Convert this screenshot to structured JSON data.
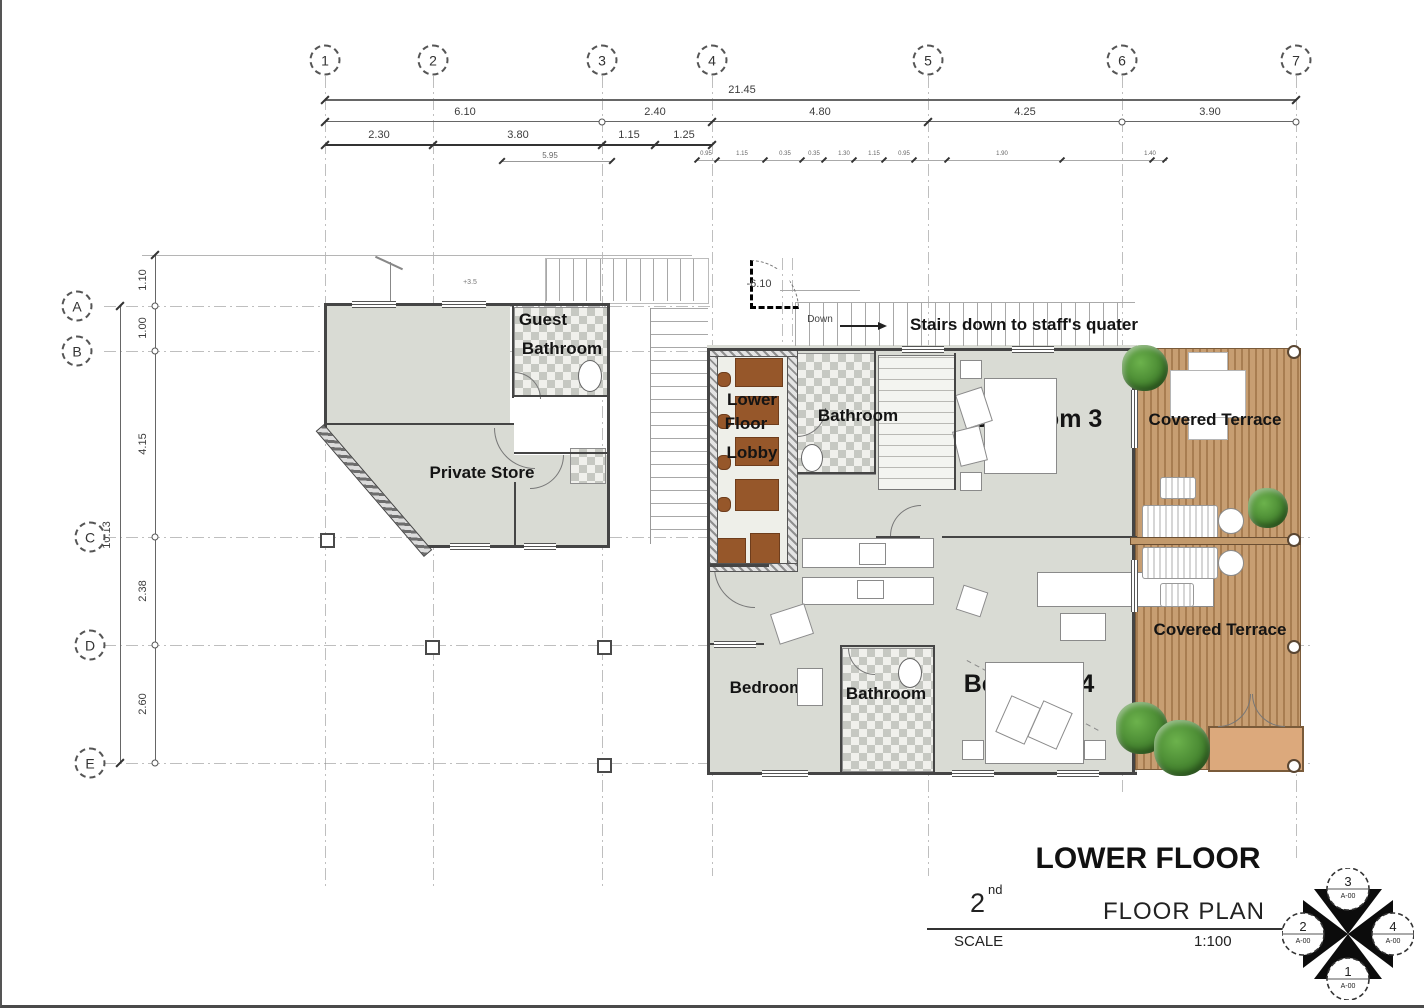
{
  "grid": {
    "columns": [
      "1",
      "2",
      "3",
      "4",
      "5",
      "6",
      "7"
    ],
    "rows": [
      "A",
      "B",
      "C",
      "D",
      "E"
    ]
  },
  "dims": {
    "total": "21.45",
    "seg2": [
      "6.10",
      "2.40",
      "4.80",
      "4.25",
      "3.90"
    ],
    "seg3": [
      "2.30",
      "3.80",
      "1.15",
      "1.25"
    ],
    "sub": "5.95",
    "tiny": [
      "0.95",
      "1.15",
      "0.35",
      "0.35",
      "1.30",
      "1.15",
      "0.95",
      "1.90",
      "1.40"
    ],
    "left": [
      "1.10",
      "1.00",
      "4.15",
      "2.38",
      "2.60"
    ],
    "left_total": "10.13"
  },
  "levels": {
    "lobby": "-6.10",
    "entry": "+3.5",
    "down": "Down"
  },
  "note": {
    "stairs": "Stairs down to staff's quater"
  },
  "rooms": {
    "guest_bath_line1": "Guest",
    "guest_bath_line2": "Bathroom",
    "private_store": "Private Store",
    "lobby_line1": "Lower",
    "lobby_line2": "Floor",
    "lobby_line3": "Lobby",
    "bath_top": "Bathroom",
    "bedroom3": "Bedroom 3",
    "terrace_top": "Covered Terrace",
    "bedroom5": "Bedroom 5",
    "bath_bottom": "Bathroom",
    "bedroom4": "Bedroom 4",
    "terrace_bottom": "Covered Terrace"
  },
  "title_block": {
    "title": "LOWER FLOOR",
    "floor_num": "2",
    "floor_ord": "nd",
    "plan": "FLOOR PLAN",
    "scale_label": "SCALE",
    "scale_value": "1:100"
  },
  "compass": {
    "top": {
      "num": "3",
      "ref": "A-00"
    },
    "left": {
      "num": "2",
      "ref": "A-00"
    },
    "right": {
      "num": "4",
      "ref": "A-00"
    },
    "bottom": {
      "num": "1",
      "ref": "A-00"
    }
  },
  "colors": {
    "room_fill": "#d9dbd4",
    "terrace_wood": "#c79e72",
    "lobby_brown": "#96572a",
    "tree_green": "#3f7d2b",
    "wall": "#454545"
  }
}
